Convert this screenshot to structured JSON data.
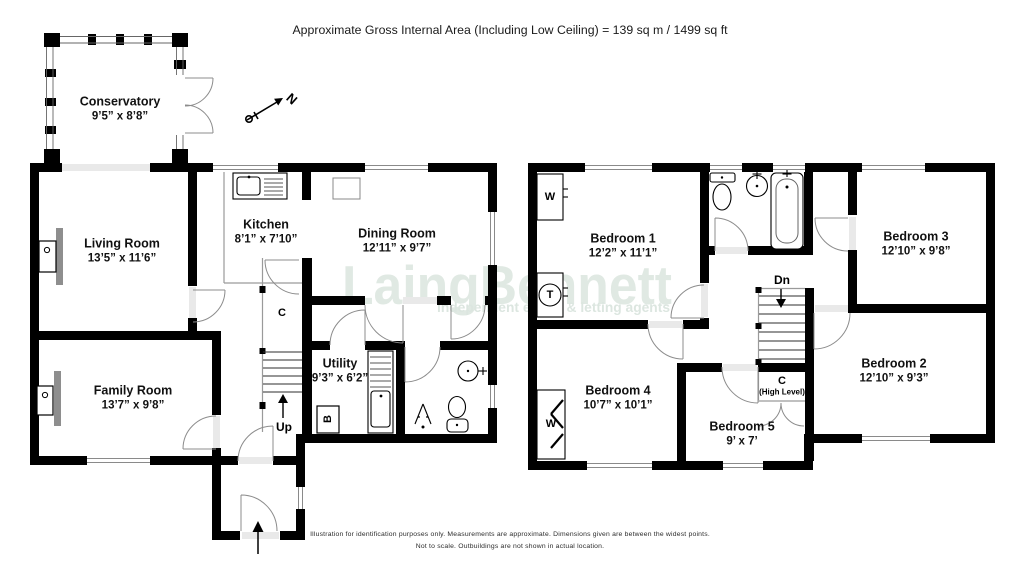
{
  "header": {
    "title": "Approximate Gross Internal Area (Including Low Ceiling) = 139 sq m / 1499 sq ft"
  },
  "watermark": {
    "brand": "LaingBennett",
    "tagline": "independent estate & letting agents"
  },
  "compass": {
    "north_label": "N"
  },
  "ground_floor": {
    "rooms": {
      "conservatory": {
        "name": "Conservatory",
        "dims": "9’5” x 8’8”"
      },
      "living_room": {
        "name": "Living Room",
        "dims": "13’5” x 11’6”"
      },
      "kitchen": {
        "name": "Kitchen",
        "dims": "8’1” x 7’10”"
      },
      "dining_room": {
        "name": "Dining Room",
        "dims": "12’11” x 9’7”"
      },
      "family_room": {
        "name": "Family Room",
        "dims": "13’7” x 9’8”"
      },
      "utility": {
        "name": "Utility",
        "dims": "9’3” x 6’2”"
      }
    },
    "annotations": {
      "stairs_up": "Up",
      "cupboard": "C",
      "boiler": "B"
    }
  },
  "first_floor": {
    "rooms": {
      "bedroom_1": {
        "name": "Bedroom 1",
        "dims": "12’2” x 11’1”"
      },
      "bedroom_2": {
        "name": "Bedroom 2",
        "dims": "12’10” x 9’3”"
      },
      "bedroom_3": {
        "name": "Bedroom 3",
        "dims": "12’10” x 9’8”"
      },
      "bedroom_4": {
        "name": "Bedroom 4",
        "dims": "10’7” x 10’1”"
      },
      "bedroom_5": {
        "name": "Bedroom 5",
        "dims": "9’ x 7’"
      }
    },
    "annotations": {
      "stairs_down": "Dn",
      "cupboard": "C",
      "cupboard_note": "(High Level)",
      "wardrobe_1": "W",
      "wardrobe_4": "W",
      "tank": "T"
    }
  },
  "footer": {
    "line1": "Illustration for identification purposes only.  Measurements are approximate. Dimensions given are between the widest points.",
    "line2": "Not to scale.  Outbuildings are not shown in actual location."
  }
}
